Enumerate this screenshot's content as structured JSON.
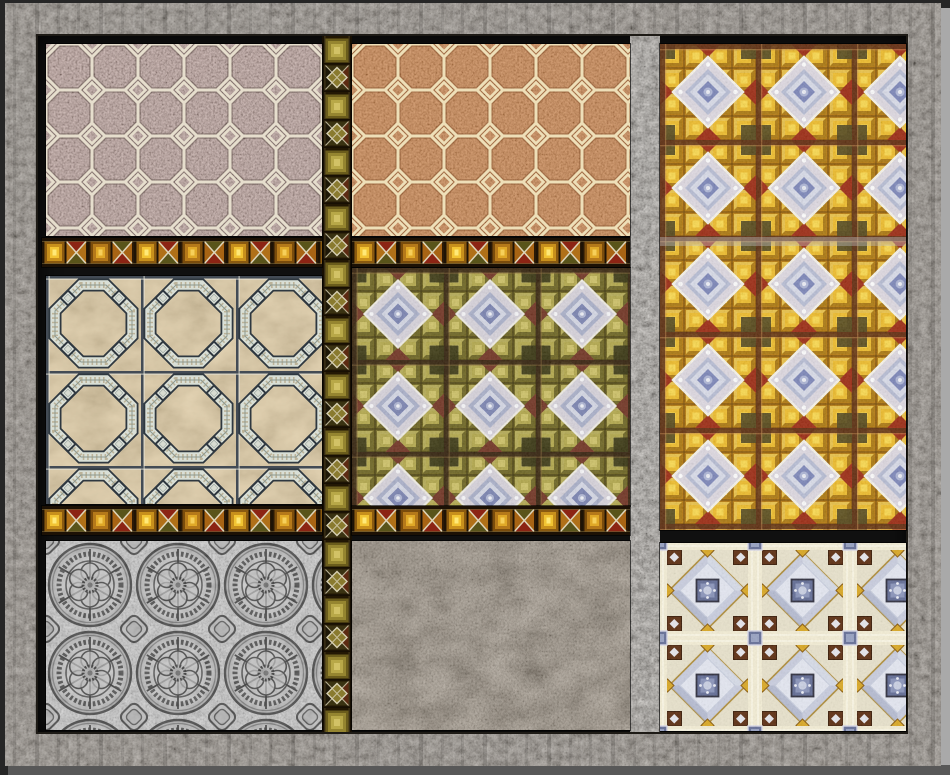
{
  "scene": {
    "type": "texture-collage",
    "title": "Decorative tile and stone texture sampler",
    "background_color": "#262626",
    "edge_highlight_color": "#a9a9a9",
    "edge_shadow_color": "#585858",
    "well_color": "#101010",
    "frame": {
      "label": "Weathered stone frame",
      "base_color": "#7d756a"
    },
    "panels": [
      {
        "label": "Pink granite octagon tile floor",
        "base_color": "#aa8f8a",
        "grout_color": "#e6decd"
      },
      {
        "label": "Terracotta octagon tile floor",
        "base_color": "#c07a43",
        "grout_color": "#eedfb8"
      },
      {
        "label": "Golden kaleidoscope mosaic",
        "base_color": "#d39a16",
        "accent_colors": [
          "#9c2a12",
          "#4f451b",
          "#ddd8e0",
          "#7c86b8"
        ]
      },
      {
        "label": "Beige marble coffered panels",
        "base_color": "#d9c49c",
        "frame_color": "#d9dfd6"
      },
      {
        "label": "Olive kaleidoscope mosaic",
        "base_color": "#938833",
        "accent_colors": [
          "#713423",
          "#33310f",
          "#d6d2da",
          "#7a83b0"
        ]
      },
      {
        "label": "Silver embossed medallion relief",
        "base_color": "#c6c6c6",
        "line_color": "#474747"
      },
      {
        "label": "Carved brown stone",
        "base_color": "#897a66"
      },
      {
        "label": "Ivory and lavender mosaic",
        "base_color": "#e7e1cb",
        "accent_colors": [
          "#c9cdde",
          "#646e96",
          "#5e3014",
          "#d9a826"
        ]
      }
    ],
    "dividers": {
      "gold_trim_label": "Gold diamond trim strip",
      "gold_trim_colors": [
        "#f2c433",
        "#8c2414",
        "#59541a",
        "#2a1906"
      ],
      "mosaic_strip_label": "Olive mosaic divider strip",
      "stone_pillar_label": "Stone pillar divider",
      "gray_band_label": "Translucent gray band"
    }
  }
}
